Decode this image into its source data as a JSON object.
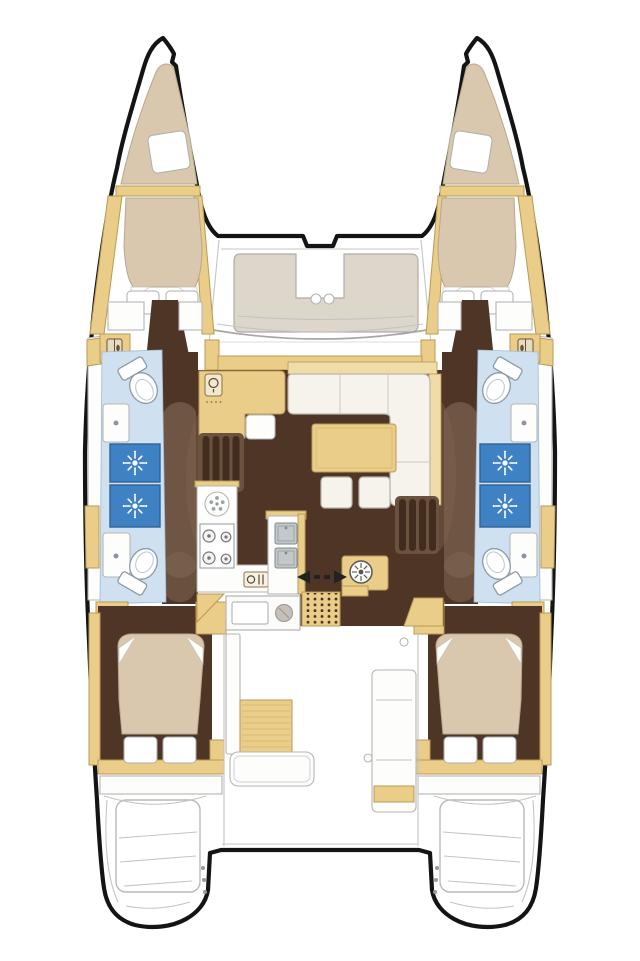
{
  "page": {
    "title": "Catamaran interior layout floor plan",
    "description": "Top-down deck plan of a twin-hull sailing catamaran: two bow peaks with V-cushions, four double cabins, four bathroom zones with shower stalls, central saloon with galley, nav station, L-sofa and table, forward U-shaped cockpit seat, aft cockpit with table and benches, and twin transom swim platforms.",
    "background": "#ffffff"
  },
  "colors": {
    "outline": "#141414",
    "wood": "#e9cd88",
    "wood_light": "#f0dca6",
    "wood_edge": "#b99a55",
    "floor_dark": "#4e3526",
    "floor_mid": "#7d6450",
    "bed": "#d9c8ad",
    "sofa": "#f6f3ec",
    "seat": "#dcd6cb",
    "bath": "#cfe0f0",
    "shower": "#3f82c4",
    "steel": "#c3c9cb",
    "line": "#b5b5b5"
  },
  "vessel": {
    "type": "catamaran",
    "view": "top-down interior plan",
    "hulls": [
      "port",
      "starboard"
    ]
  },
  "areas": {
    "bow_peaks": {
      "count": 2,
      "contents": "tapered V-berth cushion with one pillow each"
    },
    "foredeck_cockpit": {
      "seating": "U-shaped forward-facing bench",
      "cupholders": 2
    },
    "per_hull": {
      "forward_cabin": {
        "bed": "tapered double berth",
        "pillows": 2,
        "wardrobe_lockers": 1,
        "side_shelves": 2
      },
      "bathroom_block": {
        "toilets": 2,
        "washbasins": 2,
        "shower_stalls": 2
      },
      "aft_cabin": {
        "bed": "double berth",
        "pillows": 2,
        "wardrobe_lockers": 1
      },
      "transom": {
        "swim_platform": 1,
        "steps": 3,
        "hinge_dots": 3
      }
    },
    "saloon": {
      "nav_station": {
        "desk": true,
        "seat": 1,
        "instrument_icon": true
      },
      "sofa": "L-shaped cream settee",
      "ottomans": 2,
      "dining_table": 1,
      "galley": {
        "burners": 4,
        "round_sink": 1,
        "double_sink_bowls": 2,
        "oven_icon": 1
      },
      "companionway_step_sets": 2,
      "steps_per_set": 4,
      "sliding_door_symbol": "double arrow",
      "round_appliance": 1
    },
    "aft_cockpit": {
      "table": 1,
      "benches": 3,
      "outdoor_module": {
        "sink": 1,
        "round_grill_item": 1
      },
      "threshold_mat": {
        "dot_grid": true
      }
    }
  },
  "icons": [
    {
      "name": "shower-jet-icon",
      "glyph": "white sunburst on blue square"
    },
    {
      "name": "toilet-icon",
      "glyph": "oval bowl with cistern"
    },
    {
      "name": "washbasin-icon",
      "glyph": "rectangle with drain dot"
    },
    {
      "name": "stove-burner-icon",
      "glyph": "circle with center dot"
    },
    {
      "name": "round-appliance-icon",
      "glyph": "spoked wheel in cabinet"
    },
    {
      "name": "wardrobe-icon",
      "glyph": "locker door with handle"
    },
    {
      "name": "nav-instrument-icon",
      "glyph": "dial in rounded panel"
    },
    {
      "name": "sliding-door-arrows-icon",
      "glyph": "opposed black arrows with dashes"
    },
    {
      "name": "oven-icon",
      "glyph": "small appliance front"
    }
  ]
}
